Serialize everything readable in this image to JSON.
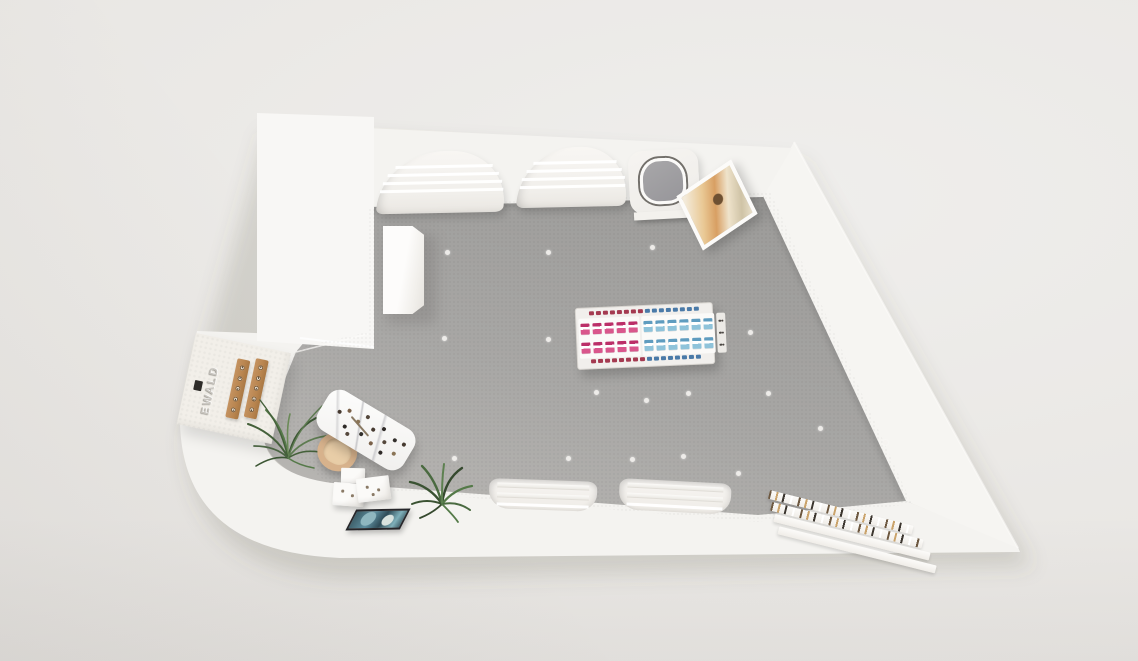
{
  "scene": {
    "kind": "3D top-down render of an optical / jewelry retail store floor plan",
    "brand": {
      "logo_text": "EWALD"
    },
    "palette": {
      "background": "#eae8e5",
      "wall_white": "#f4f3f0",
      "roof_white": "#f8f7f5",
      "floor_dark": "#9e9d9b",
      "floor_light": "#b6b4b1",
      "wood": "#b9854f",
      "plant_green": "#4a6442",
      "chair_tan": "#d7b28c",
      "product_pink": "#d9578c",
      "product_pink_stripe": "#bb2f68",
      "product_blue": "#8fc3da",
      "product_blue_stripe": "#5f9cbf",
      "rim_red": "#a43a50",
      "rim_blue": "#4a7aa8",
      "art_warm_mid": "#d89f63",
      "art_cool_mid": "#5f8fa0",
      "frame_dark": "#26262a"
    },
    "floor_dots": [
      [
        447,
        252
      ],
      [
        548,
        252
      ],
      [
        652,
        247
      ],
      [
        444,
        338
      ],
      [
        548,
        339
      ],
      [
        650,
        336
      ],
      [
        750,
        332
      ],
      [
        596,
        392
      ],
      [
        646,
        400
      ],
      [
        688,
        393
      ],
      [
        768,
        393
      ],
      [
        820,
        428
      ],
      [
        885,
        442
      ],
      [
        454,
        458
      ],
      [
        568,
        458
      ],
      [
        632,
        459
      ],
      [
        683,
        456
      ],
      [
        738,
        473
      ]
    ],
    "fixtures": {
      "top_wall_displays": {
        "count": 2,
        "shelf_rows": 4
      },
      "bottom_wall_displays": {
        "count": 2,
        "shelf_rows": 3,
        "plain_rows": 2
      },
      "gondola": {
        "rim_marks": 16,
        "halves": [
          {
            "side": "left",
            "rows": 2,
            "per_row": 5,
            "color": "#d9578c",
            "stripe": "#bb2f68"
          },
          {
            "side": "right",
            "rows": 2,
            "per_row": 6,
            "color": "#8fc3da",
            "stripe": "#5f9cbf"
          }
        ],
        "end_cap_dots": 6
      },
      "wood_display_strips": {
        "count": 2,
        "slots_each": 5
      },
      "step_display": {
        "steps": 4,
        "speckled_steps": 2
      },
      "display_cubes": 3,
      "table_items": [
        {
          "x": 16,
          "y": 42,
          "c": "#463a30"
        },
        {
          "x": 24,
          "y": 28,
          "c": "#7a6149"
        },
        {
          "x": 28,
          "y": 62,
          "c": "#2e2a27"
        },
        {
          "x": 37,
          "y": 40,
          "c": "#8a7456"
        },
        {
          "x": 43,
          "y": 20,
          "c": "#55483c"
        },
        {
          "x": 46,
          "y": 58,
          "c": "#33302c"
        },
        {
          "x": 54,
          "y": 36,
          "c": "#463a30"
        },
        {
          "x": 59,
          "y": 66,
          "c": "#7a6149"
        },
        {
          "x": 63,
          "y": 24,
          "c": "#2e2a27"
        },
        {
          "x": 70,
          "y": 48,
          "c": "#55483c"
        },
        {
          "x": 78,
          "y": 32,
          "c": "#33302c"
        },
        {
          "x": 84,
          "y": 58,
          "c": "#8a7456"
        },
        {
          "x": 88,
          "y": 30,
          "c": "#463a30"
        },
        {
          "x": 34,
          "y": 74,
          "c": "#55483c"
        },
        {
          "x": 72,
          "y": 72,
          "c": "#2e2a27"
        }
      ]
    }
  }
}
